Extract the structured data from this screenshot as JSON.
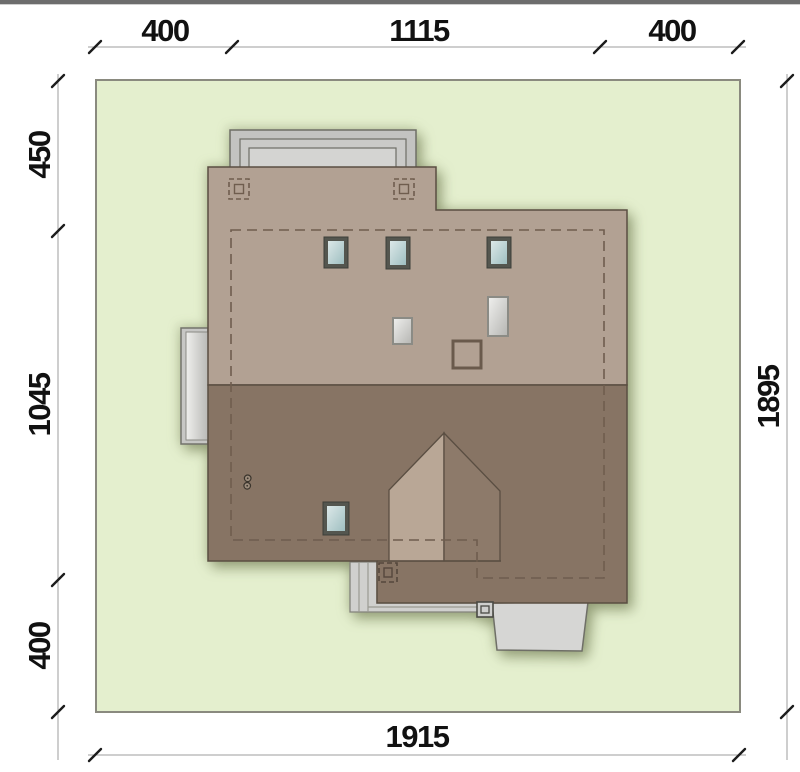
{
  "plan": {
    "title": "house-site-plan-roof-view",
    "plot": {
      "width_units": "1915",
      "height_units": "1895",
      "fill": "#e4efce",
      "border": "#8a8a7f"
    },
    "dimensions": {
      "top": {
        "segments": [
          "400",
          "1115",
          "400"
        ]
      },
      "left": {
        "segments": [
          "450",
          "1045",
          "400"
        ]
      },
      "right": {
        "total": "1895"
      },
      "bottom": {
        "total": "1915"
      }
    },
    "colors": {
      "top_bar": "#6d6d6d",
      "roof_upper": "#b2a193",
      "roof_lower": "#877464",
      "dormer_light": "#b9a796",
      "dormer_dark": "#8d7a6a",
      "roof_outline": "#5a4e42",
      "dashed_footprint": "#6f5d4e",
      "terrace_gray": "#c3c3c1",
      "stairs_gray": "#d0d0ce",
      "entry_gray": "#d6d6d4",
      "skylight_frame": "#54564f",
      "skylight_glass": "#c8dcdc",
      "roof_window_white": "#e9e9e7",
      "dimension_line": "#9c9c9c",
      "dimension_tick": "#1c1c1c"
    },
    "symbols": {
      "chimney": "dashed-square-with-inner-square",
      "skylight": "blue-glass-rect",
      "roof_window": "white-rect",
      "vent": "small-circle-pair"
    }
  }
}
